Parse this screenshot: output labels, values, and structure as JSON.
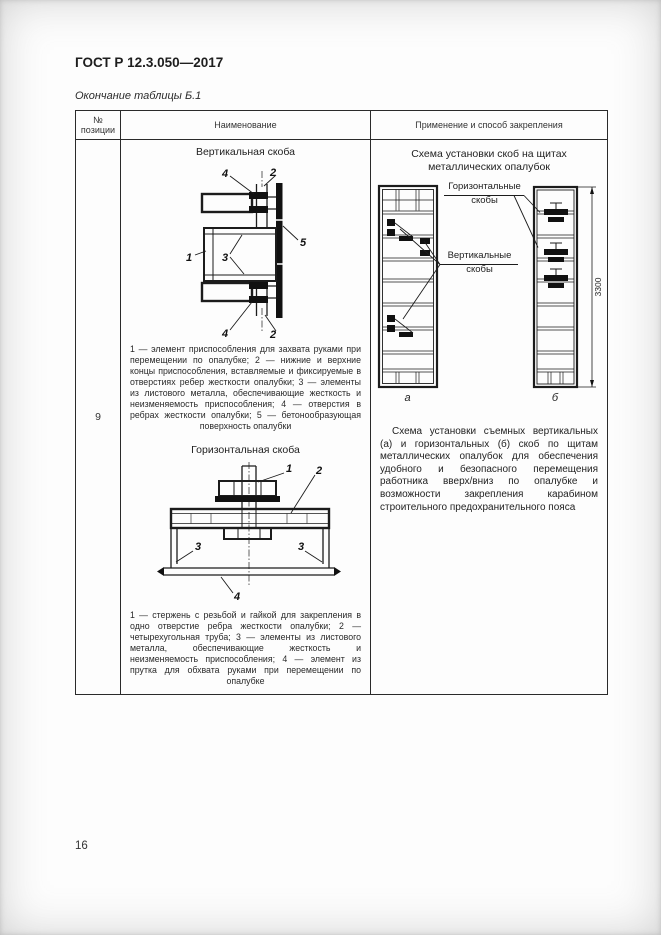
{
  "page": {
    "doc_number": "ГОСТ Р 12.3.050—2017",
    "table_caption": "Окончание таблицы Б.1",
    "page_number": "16"
  },
  "table": {
    "col_position": "№ позиции",
    "col_name": "Наименование",
    "col_application": "Применение и способ закрепления",
    "position": "9"
  },
  "vertical_clamp": {
    "title": "Вертикальная скоба",
    "callouts": [
      "4",
      "2",
      "1",
      "3",
      "5",
      "4",
      "2"
    ],
    "legend": "1 — элемент приспособления для захвата руками при перемещении по опалубке; 2 — нижние и верхние концы приспособления, вставляемые и фиксируемые в отверстиях ребер жесткости опалубки; 3 — элементы из листового металла, обеспечивающие жесткость и неизменяемость приспособления; 4 — отверстия в ребрах жесткости опалубки; 5 — бетонообразующая поверхность опалубки"
  },
  "horizontal_clamp": {
    "title": "Горизонтальная скоба",
    "callouts": [
      "1",
      "2",
      "3",
      "3",
      "4"
    ],
    "legend": "1 — стержень с резьбой и гайкой для закрепления в одно отверстие ребра жесткости опалубки; 2 — четырехугольная труба; 3 — элементы из листового металла, обеспечивающие жесткость и неизменяемость приспособления; 4 — элемент из прутка для обхвата руками при перемещении по опалубке"
  },
  "scheme": {
    "title": "Схема установки скоб на щитах металлических опалубок",
    "label_horizontal": "Горизонтальные скобы",
    "label_vertical": "Вертикальные скобы",
    "panel_a_label": "а",
    "panel_b_label": "б",
    "dimension": "3300",
    "description": "Схема установки съемных вертикальных (а) и горизонтальных (б) скоб по щитам металлических опалубок для обеспечения удобного и безопасного перемещения работника вверх/вниз по опалубке и возможности закрепления карабином строительного предохранительного пояса"
  },
  "colors": {
    "line": "#1c1c1c",
    "text": "#222222",
    "page_background": "#fdfdfd"
  }
}
